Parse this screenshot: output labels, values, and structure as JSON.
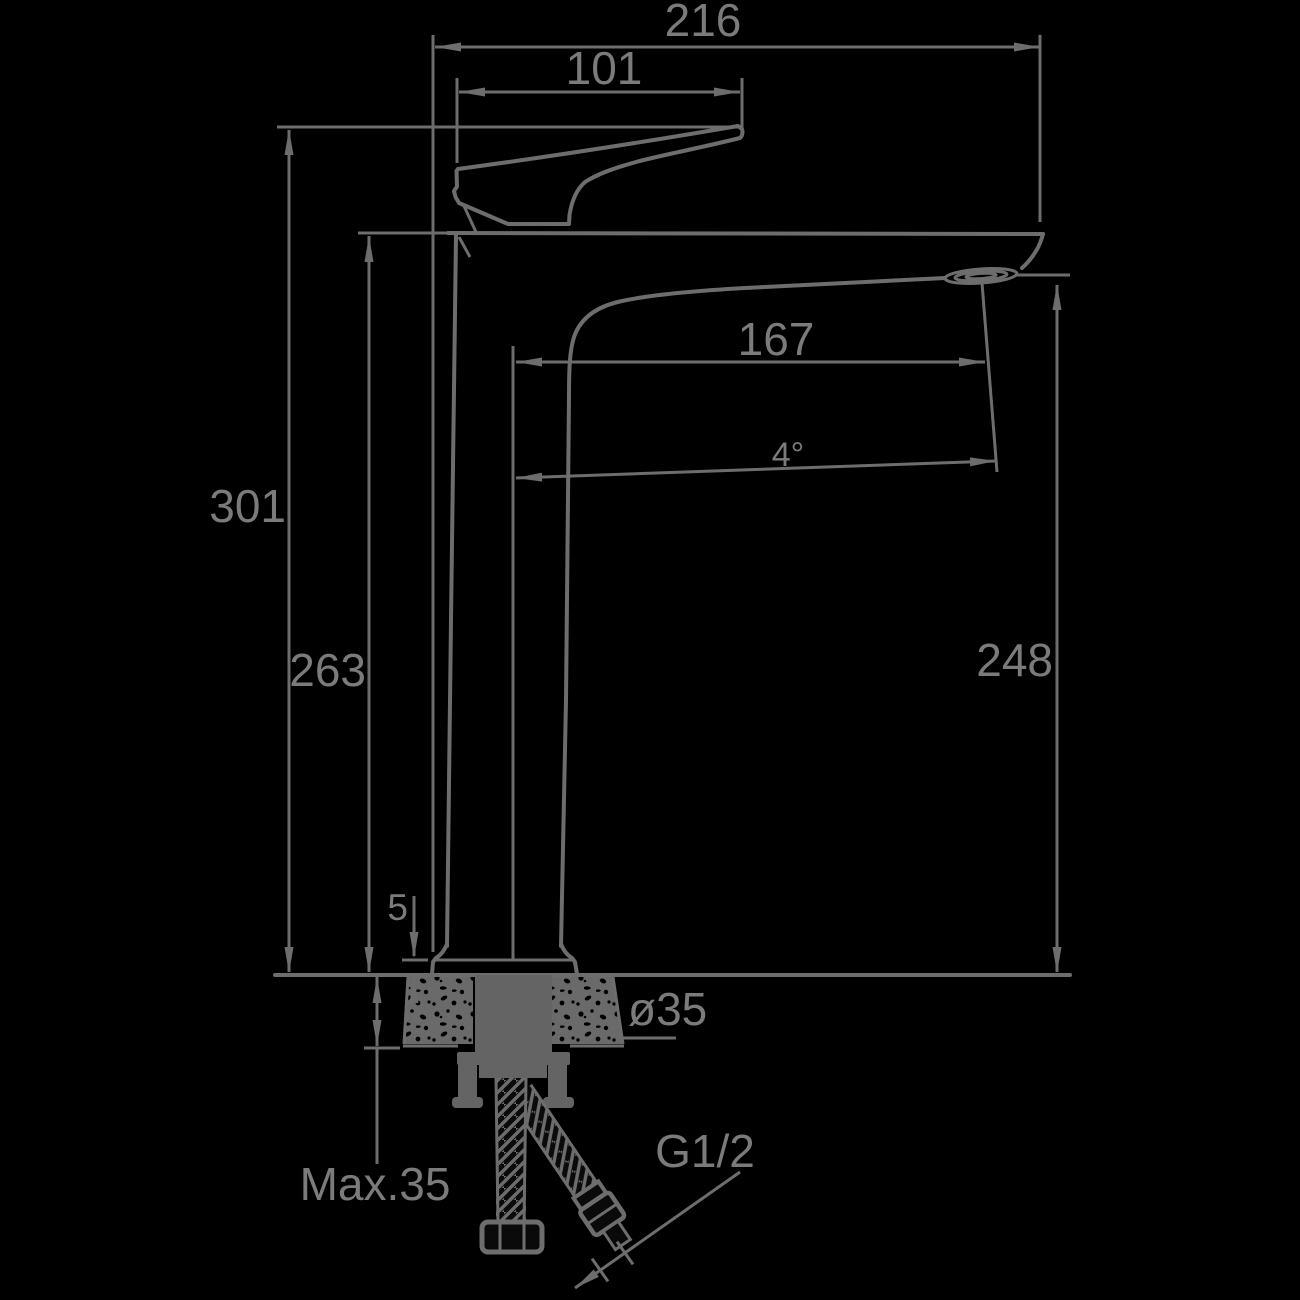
{
  "drawing": {
    "colors": {
      "background": "#000000",
      "line": "#6d6d6d",
      "text": "#7b7b7b"
    },
    "dimensions": {
      "overall_width": "216",
      "handle_length": "101",
      "spout_reach": "167",
      "spout_angle": "4°",
      "total_height": "301",
      "body_height": "263",
      "spout_height": "248",
      "base_plate_gap": "5",
      "hole_diameter": "ø35",
      "max_counter_thickness": "Max.35",
      "connection_thread": "G1/2"
    }
  }
}
